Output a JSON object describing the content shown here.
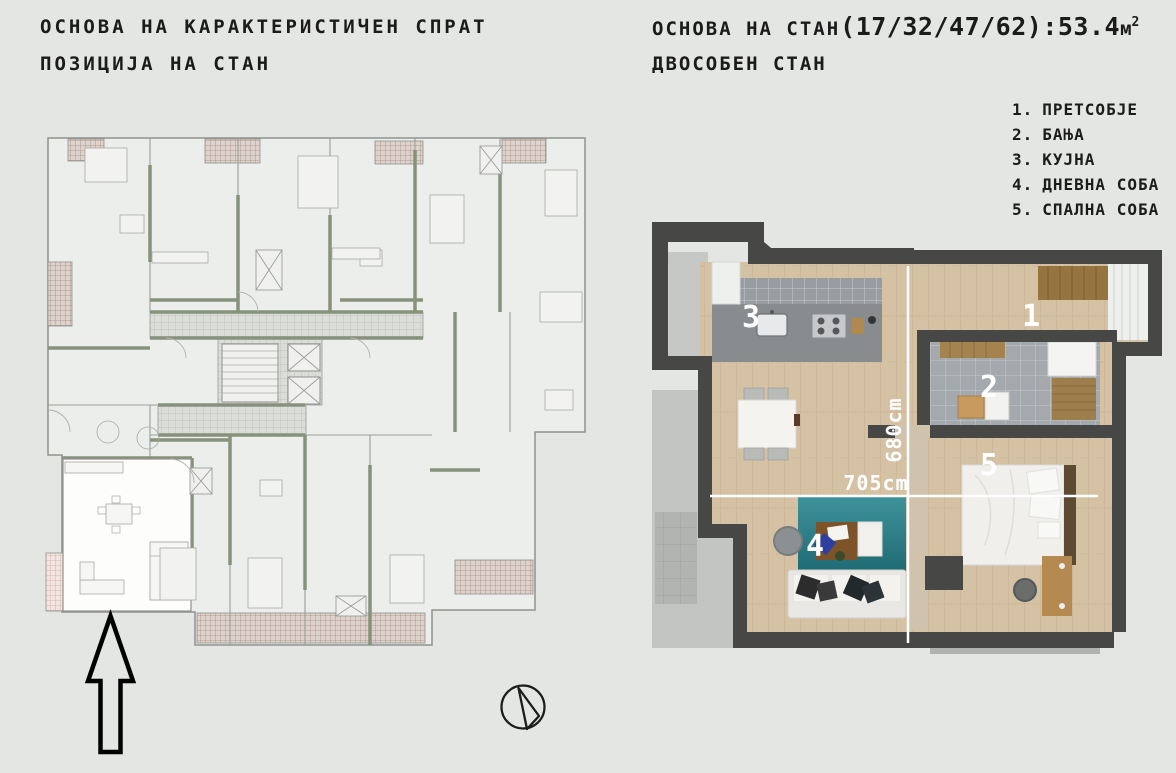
{
  "background": "#e4e6e3",
  "header_left": {
    "line1": "ОСНОВА НА КАРАКТЕРИСТИЧЕН СПРАТ",
    "line2": "ПОЗИЦИЈА НА СТАН"
  },
  "header_right": {
    "prefix": "ОСНОВА НА СТАН ",
    "numbers": "(17/32/47/62):53.4",
    "unit": "м",
    "unit_sup": "2",
    "subtitle": "ДВОСОБЕН СТАН"
  },
  "legend": {
    "items": [
      {
        "num": "1.",
        "label": "ПРЕТСОБЈЕ"
      },
      {
        "num": "2.",
        "label": "БАЊА"
      },
      {
        "num": "3.",
        "label": "КУЈНА"
      },
      {
        "num": "4.",
        "label": "ДНЕВНА СОБА"
      },
      {
        "num": "5.",
        "label": "СПАЛНА СОБА"
      }
    ]
  },
  "apartment_plan": {
    "room_labels": {
      "hall": "1",
      "bath": "2",
      "kitchen": "3",
      "living": "4",
      "bedroom": "5"
    },
    "dim_vertical": "680cm",
    "dim_horizontal": "705cm"
  },
  "colors": {
    "wall_dark": "#474745",
    "wood_floor": "#d5c2a5",
    "accent_teal": "#2f8089",
    "plan_wall_olive": "#87927d",
    "balcony_hatch": "#a28b83"
  }
}
